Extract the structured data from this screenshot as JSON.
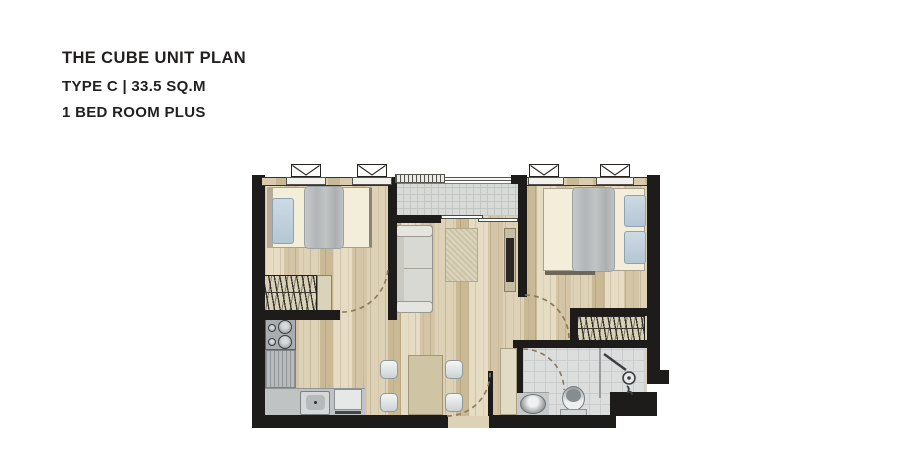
{
  "header": {
    "title": "THE CUBE UNIT PLAN",
    "type_line": "TYPE C | 33.5 SQ.M",
    "bedroom_line": "1 BED ROOM PLUS",
    "text_color": "#221f1f"
  },
  "floorplan": {
    "colors": {
      "wall": "#1e1c1a",
      "wood_floor": "#dbceb2",
      "balcony_tile": "#d8dad7",
      "bathroom_tile": "#dcdedd",
      "mattress": "#f3eeda",
      "pillow": "#c0d0dc",
      "blanket": "#b8bcbd",
      "sofa": "#d9d9d3",
      "rug": "#cdc4a6",
      "counter": "#c0c3c4",
      "door_arc": "#8a7a58"
    },
    "rooms": [
      "bedroom",
      "master-bedroom",
      "living-dining",
      "kitchen",
      "bathroom",
      "balcony"
    ],
    "furniture": [
      "single-bed",
      "double-bed",
      "wardrobe",
      "sofa",
      "rug",
      "tv-console",
      "dining-table",
      "dining-chair",
      "stove",
      "kitchen-sink",
      "appliance",
      "wash-basin",
      "toilet",
      "shower",
      "sliding-door",
      "window"
    ]
  }
}
